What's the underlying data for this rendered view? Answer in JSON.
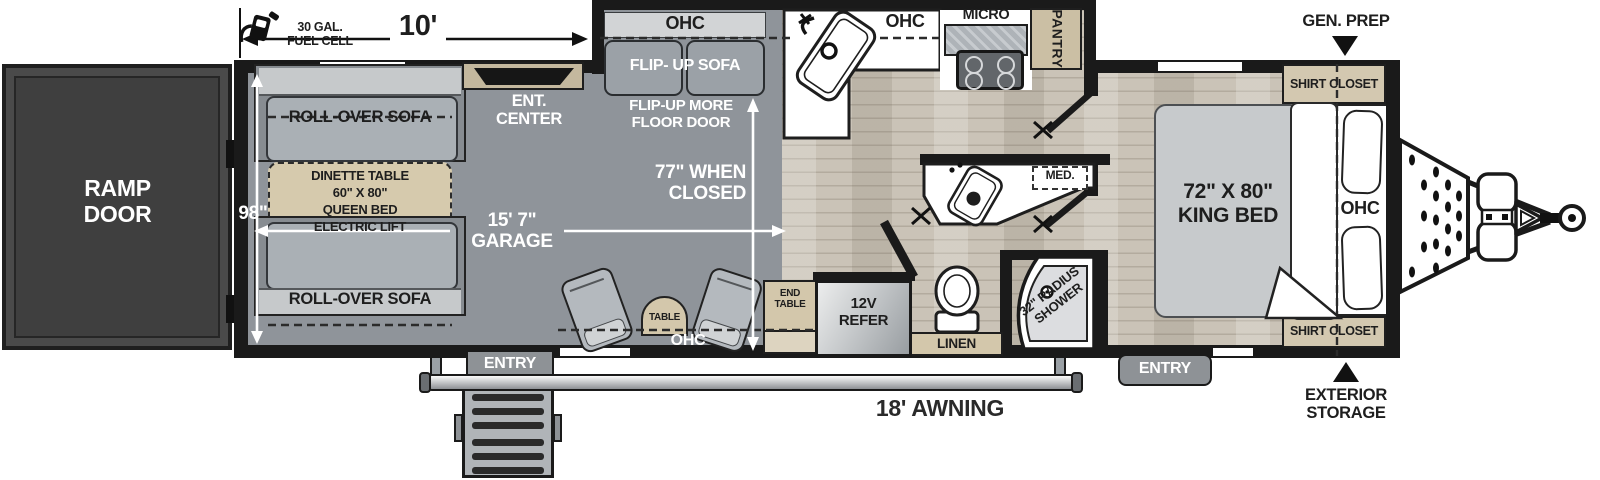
{
  "title": "Toy Hauler Travel Trailer Floorplan",
  "colors": {
    "wall": "#1a1a1a",
    "garage_floor": "#8f949a",
    "wood_floor": "#cac3b7",
    "cabinet_tan": "#d3c7ab",
    "sofa_gray": "#a9aeb3",
    "ramp_door_gray": "#454545"
  },
  "labels": {
    "ramp_door": "RAMP\nDOOR",
    "fuel_cell": "30 GAL.\nFUEL CELL",
    "dim_10ft": "10'",
    "dim_98in": "98\"",
    "dim_garage": "15' 7\"\nGARAGE",
    "dim_closed": "77\" WHEN\nCLOSED",
    "rollover_sofa": "ROLL-OVER SOFA",
    "dinette": "DINETTE TABLE\n60\" X 80\"\nQUEEN BED\nELECTRIC LIFT",
    "ent_center": "ENT.\nCENTER",
    "ohc": "OHC",
    "flip_up_sofa": "FLIP- UP SOFA",
    "flip_up_more": "FLIP-UP MORE\nFLOOR DOOR",
    "micro": "MICRO",
    "pantry": "PANTRY",
    "gen_prep": "GEN. PREP",
    "shirt_closet": "SHIRT CLOSET",
    "king_bed": "72\" X 80\"\nKING BED",
    "med": "MED.",
    "shower": "32\" RADIUS\nSHOWER",
    "linen": "LINEN",
    "refer": "12V\nREFER",
    "end_table": "END\nTABLE",
    "table": "TABLE",
    "entry": "ENTRY",
    "awning": "18' AWNING",
    "exterior_storage": "EXTERIOR\nSTORAGE"
  }
}
